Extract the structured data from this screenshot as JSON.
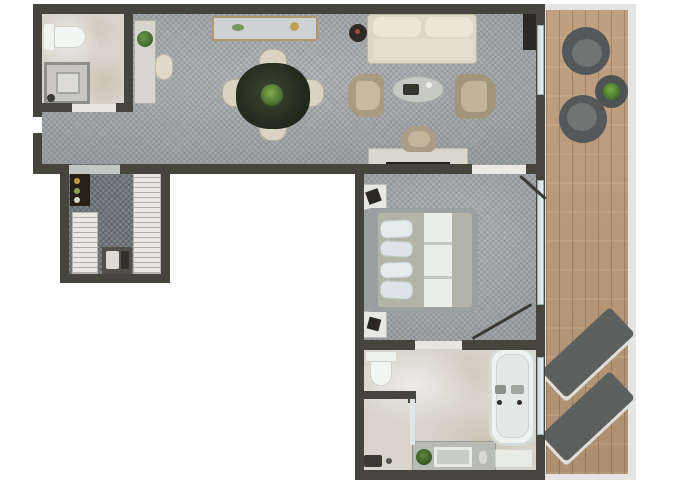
{
  "title": "hotel-suite-floor-plan",
  "canvas": {
    "w": 680,
    "h": 486
  },
  "palette": {
    "wall": "#45443d",
    "carpet": "#a6a9ab",
    "carpet_dark": "#7b8084",
    "marble": "#d8d4ca",
    "wood": "#b79878",
    "railing": "#e4e5e2",
    "cream_fabric": "#dcd8c8",
    "tan_fabric": "#a99b80",
    "dining_table_green": "#27301f",
    "outdoor_gray": "#54585a",
    "fixture_white": "#f2f5f2",
    "plant_green": "#4c7a35",
    "glass": "#dce6e7"
  },
  "floors": [
    {
      "name": "living-room-floor",
      "cls": "floor-carpet",
      "x": 42,
      "y": 12,
      "w": 494,
      "h": 152
    },
    {
      "name": "entry-bathroom-floor",
      "cls": "floor-marble",
      "x": 40,
      "y": 12,
      "w": 92,
      "h": 94
    },
    {
      "name": "closet-floor",
      "cls": "floor-carpet-dark",
      "x": 64,
      "y": 164,
      "w": 104,
      "h": 115
    },
    {
      "name": "bedroom-floor",
      "cls": "floor-carpet",
      "x": 360,
      "y": 164,
      "w": 178,
      "h": 182
    },
    {
      "name": "main-bathroom-floor",
      "cls": "floor-marble",
      "x": 360,
      "y": 346,
      "w": 178,
      "h": 128
    },
    {
      "name": "balcony-railing",
      "x": 544,
      "y": 4,
      "w": 92,
      "h": 476,
      "bg": "#e4e5e2"
    },
    {
      "name": "balcony-floor",
      "cls": "floor-wood",
      "x": 546,
      "y": 10,
      "w": 82,
      "h": 464
    }
  ],
  "furniture": [
    {
      "name": "toilet-tank-entry",
      "x": 44,
      "y": 24,
      "w": 10,
      "h": 26,
      "bg": "#f1f3f0",
      "r": "2px"
    },
    {
      "name": "toilet-bowl-entry",
      "x": 54,
      "y": 26,
      "w": 32,
      "h": 22,
      "bg": "#f3f5f2",
      "r": "2px 12px 12px 2px",
      "b": "1px solid #cfd1cc"
    },
    {
      "name": "shower-entry",
      "x": 44,
      "y": 62,
      "w": 46,
      "h": 42,
      "bg": "#c9c8c0",
      "b": "3px solid #8e8f88"
    },
    {
      "name": "shower-entry-tray",
      "x": 56,
      "y": 72,
      "w": 24,
      "h": 22,
      "bg": "#dddcd4",
      "b": "2px solid #a7a8a0"
    },
    {
      "name": "shower-entry-drain",
      "x": 47,
      "y": 94,
      "w": 8,
      "h": 8,
      "bg": "#3c3a34",
      "r": "50%"
    },
    {
      "name": "hall-cabinet",
      "x": 134,
      "y": 20,
      "w": 22,
      "h": 84,
      "bg": "#d6d6ce",
      "b": "1px solid #b2b2aa"
    },
    {
      "name": "hall-cabinet-plant",
      "x": 137,
      "y": 31,
      "w": 16,
      "h": 16,
      "bg": "radial-gradient(circle at 40% 40%, #6a9448, #2f5122)",
      "r": "50%"
    },
    {
      "name": "hall-chair",
      "x": 155,
      "y": 54,
      "w": 18,
      "h": 26,
      "bg": "#e0dbc9",
      "r": "9px",
      "b": "1px solid #bdb8a6"
    },
    {
      "name": "credenza",
      "x": 212,
      "y": 16,
      "w": 106,
      "h": 25,
      "bg": "#ccd3d2",
      "b": "2px solid #b0976d",
      "r": "3px"
    },
    {
      "name": "credenza-decor-green",
      "x": 232,
      "y": 24,
      "w": 12,
      "h": 7,
      "bg": "#79985f",
      "r": "50%"
    },
    {
      "name": "credenza-decor-gold",
      "x": 290,
      "y": 22,
      "w": 9,
      "h": 9,
      "bg": "#bfa258",
      "r": "50%"
    },
    {
      "name": "dining-chair-north",
      "x": 259,
      "y": 49,
      "w": 28,
      "h": 24,
      "bg": "#d9d4c2",
      "r": "12px 12px 6px 6px",
      "b": "1px solid #b6b09c"
    },
    {
      "name": "dining-chair-south",
      "x": 259,
      "y": 117,
      "w": 28,
      "h": 24,
      "bg": "#d9d4c2",
      "r": "6px 6px 12px 12px",
      "b": "1px solid #b6b09c"
    },
    {
      "name": "dining-chair-west",
      "x": 222,
      "y": 79,
      "w": 24,
      "h": 28,
      "bg": "#d9d4c2",
      "r": "12px 6px 6px 12px",
      "b": "1px solid #b6b09c"
    },
    {
      "name": "dining-chair-east",
      "x": 300,
      "y": 79,
      "w": 24,
      "h": 28,
      "bg": "#d9d4c2",
      "r": "6px 12px 12px 6px",
      "b": "1px solid #b6b09c"
    },
    {
      "name": "dining-table",
      "x": 236,
      "y": 63,
      "w": 74,
      "h": 66,
      "bg": "radial-gradient(circle at 45% 45%, #3a4730, #141b12)",
      "r": "46%"
    },
    {
      "name": "dining-table-plant",
      "x": 261,
      "y": 84,
      "w": 22,
      "h": 22,
      "bg": "radial-gradient(circle at 45% 40%, #7fae4e, #2c4a1d)",
      "r": "50%"
    },
    {
      "name": "sofa",
      "x": 367,
      "y": 14,
      "w": 110,
      "h": 50,
      "bg": "#dcd8c8",
      "r": "4px",
      "b": "1px solid #bbb6a4"
    },
    {
      "name": "sofa-cushion-left",
      "x": 373,
      "y": 17,
      "w": 48,
      "h": 20,
      "bg": "#eae6d8",
      "r": "8px"
    },
    {
      "name": "sofa-cushion-right",
      "x": 425,
      "y": 17,
      "w": 48,
      "h": 20,
      "bg": "#eae6d8",
      "r": "8px"
    },
    {
      "name": "sofa-seat",
      "x": 373,
      "y": 39,
      "w": 100,
      "h": 21,
      "bg": "#e3dfcf",
      "r": "3px"
    },
    {
      "name": "side-table",
      "x": 349,
      "y": 24,
      "w": 18,
      "h": 18,
      "bg": "#2e2a25",
      "r": "50%"
    },
    {
      "name": "side-table-decor",
      "x": 355,
      "y": 29,
      "w": 5,
      "h": 5,
      "bg": "#a04a3a",
      "r": "50%"
    },
    {
      "name": "coffee-table",
      "x": 392,
      "y": 76,
      "w": 52,
      "h": 27,
      "bg": "#c7cac4",
      "r": "50%",
      "b": "1px solid #a9aca6"
    },
    {
      "name": "coffee-table-tray",
      "x": 403,
      "y": 84,
      "w": 16,
      "h": 11,
      "bg": "#35372f",
      "r": "2px"
    },
    {
      "name": "coffee-table-cup",
      "x": 424,
      "y": 80,
      "w": 10,
      "h": 10,
      "bg": "#f2f2ec",
      "r": "50%",
      "b": "2px solid #c9c9c1"
    },
    {
      "name": "armchair-left",
      "x": 348,
      "y": 74,
      "w": 36,
      "h": 43,
      "bg": "#a99b80",
      "r": "16px 8px 8px 16px"
    },
    {
      "name": "armchair-left-seat",
      "x": 356,
      "y": 81,
      "w": 24,
      "h": 29,
      "bg": "#c6ba9f",
      "r": "4px 10px 10px 4px"
    },
    {
      "name": "armchair-right",
      "x": 455,
      "y": 74,
      "w": 41,
      "h": 45,
      "bg": "#a3957a",
      "r": "8px 18px 18px 8px"
    },
    {
      "name": "armchair-right-seat",
      "x": 461,
      "y": 81,
      "w": 26,
      "h": 31,
      "bg": "#c0b499",
      "r": "10px 4px 4px 10px"
    },
    {
      "name": "tv-console",
      "x": 523,
      "y": 13,
      "w": 13,
      "h": 37,
      "bg": "#2b2925"
    },
    {
      "name": "desk",
      "x": 368,
      "y": 148,
      "w": 100,
      "h": 22,
      "bg": "#d9d7ce",
      "b": "1px solid #b9b7ae"
    },
    {
      "name": "desk-tv",
      "x": 386,
      "y": 162,
      "w": 64,
      "h": 9,
      "bg": "#232220"
    },
    {
      "name": "desk-chair",
      "x": 402,
      "y": 126,
      "w": 34,
      "h": 26,
      "bg": "#ab9d85",
      "r": "13px 13px 7px 7px"
    },
    {
      "name": "desk-chair-seat",
      "x": 408,
      "y": 131,
      "w": 22,
      "h": 16,
      "bg": "#c2b69b",
      "r": "8px"
    },
    {
      "name": "minibar",
      "x": 70,
      "y": 173,
      "w": 20,
      "h": 33,
      "bg": "#262019"
    },
    {
      "name": "minibar-bottle-1",
      "x": 74,
      "y": 178,
      "w": 6,
      "h": 6,
      "bg": "#c3973f",
      "r": "50%"
    },
    {
      "name": "minibar-bottle-2",
      "x": 74,
      "y": 188,
      "w": 6,
      "h": 6,
      "bg": "#8fa050",
      "r": "50%"
    },
    {
      "name": "minibar-bottle-3",
      "x": 74,
      "y": 197,
      "w": 6,
      "h": 6,
      "bg": "#d8d8d0",
      "r": "50%"
    },
    {
      "name": "wardrobe-left",
      "cls": "rail",
      "x": 72,
      "y": 212,
      "w": 26,
      "h": 62,
      "b": "1px solid #b4b3ab"
    },
    {
      "name": "wardrobe-right",
      "cls": "rail",
      "x": 133,
      "y": 173,
      "w": 28,
      "h": 101,
      "b": "1px solid #b4b3ab"
    },
    {
      "name": "luggage-bench",
      "x": 102,
      "y": 247,
      "w": 30,
      "h": 27,
      "bg": "#524f47"
    },
    {
      "name": "luggage-item-light",
      "x": 106,
      "y": 251,
      "w": 13,
      "h": 18,
      "bg": "#dbdbd3",
      "r": "2px"
    },
    {
      "name": "luggage-item-dark",
      "x": 121,
      "y": 251,
      "w": 8,
      "h": 18,
      "bg": "#33302a",
      "r": "2px"
    },
    {
      "name": "nightstand-north",
      "x": 363,
      "y": 184,
      "w": 24,
      "h": 26,
      "bg": "#e8e8e2",
      "b": "1px solid #bcbcb4"
    },
    {
      "name": "nightstand-north-decor",
      "x": 367,
      "y": 190,
      "w": 13,
      "h": 13,
      "bg": "#2b2823",
      "rot": -20
    },
    {
      "name": "nightstand-south",
      "x": 363,
      "y": 311,
      "w": 24,
      "h": 27,
      "bg": "#e8e8e2",
      "b": "1px solid #bcbcb4"
    },
    {
      "name": "nightstand-south-decor",
      "x": 368,
      "y": 318,
      "w": 12,
      "h": 12,
      "bg": "#2b2823",
      "rot": 15
    },
    {
      "name": "bed-frame",
      "x": 362,
      "y": 208,
      "w": 116,
      "h": 104,
      "bg": "#9aa09f",
      "r": "10px 6px 6px 10px"
    },
    {
      "name": "bed-mattress",
      "x": 378,
      "y": 213,
      "w": 94,
      "h": 94,
      "bg": "#b2b4a8",
      "r": "3px"
    },
    {
      "name": "bed-runner",
      "x": 424,
      "y": 213,
      "w": 28,
      "h": 94,
      "bg": "#ecefe9"
    },
    {
      "name": "bed-runner-fold-1",
      "x": 424,
      "y": 242,
      "w": 28,
      "h": 3,
      "bg": "#c6c9bf"
    },
    {
      "name": "bed-runner-fold-2",
      "x": 424,
      "y": 276,
      "w": 28,
      "h": 3,
      "bg": "#c6c9bf"
    },
    {
      "name": "pillow-1",
      "x": 380,
      "y": 220,
      "w": 33,
      "h": 18,
      "bg": "#e6ebed",
      "r": "7px",
      "rot": -3,
      "b": "1px solid #c3cbce"
    },
    {
      "name": "pillow-2",
      "x": 380,
      "y": 241,
      "w": 33,
      "h": 16,
      "bg": "#dde4e7",
      "r": "7px",
      "rot": 2,
      "b": "1px solid #c3cbce"
    },
    {
      "name": "pillow-3",
      "x": 380,
      "y": 262,
      "w": 33,
      "h": 16,
      "bg": "#e6ebed",
      "r": "7px",
      "rot": -2,
      "b": "1px solid #c3cbce"
    },
    {
      "name": "pillow-4",
      "x": 380,
      "y": 281,
      "w": 33,
      "h": 18,
      "bg": "#dde4e7",
      "r": "7px",
      "rot": 3,
      "b": "1px solid #c3cbce"
    },
    {
      "name": "toilet-tank-main",
      "x": 366,
      "y": 352,
      "w": 30,
      "h": 9,
      "bg": "#eff1ee",
      "r": "2px"
    },
    {
      "name": "toilet-bowl-main",
      "x": 370,
      "y": 361,
      "w": 22,
      "h": 25,
      "bg": "#f3f5f2",
      "r": "3px 3px 11px 11px",
      "b": "1px solid #cfd1cc"
    },
    {
      "name": "shower-main-fixture",
      "x": 364,
      "y": 455,
      "w": 18,
      "h": 12,
      "bg": "#3b3933",
      "r": "2px"
    },
    {
      "name": "shower-main-drain",
      "x": 386,
      "y": 458,
      "w": 6,
      "h": 6,
      "bg": "#55534b",
      "r": "50%"
    },
    {
      "name": "vanity-counter",
      "x": 412,
      "y": 441,
      "w": 84,
      "h": 31,
      "bg": "#b7bbb3",
      "b": "1px solid #989c94"
    },
    {
      "name": "vanity-sink",
      "x": 434,
      "y": 447,
      "w": 38,
      "h": 20,
      "bg": "#c9cdc5",
      "b": "3px solid #e9ebe5"
    },
    {
      "name": "vanity-plant",
      "x": 416,
      "y": 449,
      "w": 16,
      "h": 16,
      "bg": "radial-gradient(circle at 45% 40%, #5d8a3c, #24401a)",
      "r": "50%"
    },
    {
      "name": "vanity-soap",
      "x": 479,
      "y": 451,
      "w": 8,
      "h": 13,
      "bg": "#d7d9d1",
      "r": "40%"
    },
    {
      "name": "bathtub",
      "x": 489,
      "y": 347,
      "w": 47,
      "h": 99,
      "bg": "#eef3f1",
      "r": "16px",
      "b": "3px solid #d5dbd7"
    },
    {
      "name": "bathtub-basin",
      "x": 496,
      "y": 354,
      "w": 33,
      "h": 84,
      "bg": "#e2e9e7",
      "r": "12px",
      "b": "1px solid #cdd4d1"
    },
    {
      "name": "bathtub-faucet-1",
      "x": 495,
      "y": 385,
      "w": 11,
      "h": 9,
      "bg": "#8e928c",
      "r": "2px"
    },
    {
      "name": "bathtub-faucet-2",
      "x": 511,
      "y": 385,
      "w": 13,
      "h": 9,
      "bg": "#a2a6a0",
      "r": "2px"
    },
    {
      "name": "bathtub-jet-1",
      "x": 497,
      "y": 400,
      "w": 5,
      "h": 5,
      "bg": "#2e2c28",
      "r": "50%"
    },
    {
      "name": "bathtub-jet-2",
      "x": 517,
      "y": 400,
      "w": 5,
      "h": 5,
      "bg": "#2e2c28",
      "r": "50%"
    },
    {
      "name": "bath-mat",
      "x": 495,
      "y": 449,
      "w": 38,
      "h": 19,
      "bg": "#e9ebe5",
      "r": "2px",
      "b": "1px solid #d2d4cc"
    },
    {
      "name": "balcony-chair-1",
      "x": 562,
      "y": 27,
      "w": 48,
      "h": 48,
      "bg": "#54585a",
      "r": "50%"
    },
    {
      "name": "balcony-chair-1-seat",
      "x": 572,
      "y": 39,
      "w": 30,
      "h": 28,
      "bg": "#707574",
      "r": "50%"
    },
    {
      "name": "balcony-chair-2",
      "x": 559,
      "y": 95,
      "w": 48,
      "h": 48,
      "bg": "#54585a",
      "r": "50%"
    },
    {
      "name": "balcony-chair-2-seat",
      "x": 567,
      "y": 103,
      "w": 30,
      "h": 28,
      "bg": "#707574",
      "r": "50%"
    },
    {
      "name": "balcony-table",
      "x": 595,
      "y": 75,
      "w": 33,
      "h": 33,
      "bg": "#4f5354",
      "r": "50%"
    },
    {
      "name": "balcony-table-plant",
      "x": 603,
      "y": 83,
      "w": 17,
      "h": 17,
      "bg": "radial-gradient(circle at 45% 40%, #77ad45, #2d511c)",
      "r": "50%"
    },
    {
      "name": "sun-lounger-1",
      "x": 541,
      "y": 334,
      "w": 94,
      "h": 37,
      "bg": "#5b5f5e",
      "r": "4px",
      "rot": -43,
      "sh": "-3px 3px 0 rgba(230,231,228,0.9)"
    },
    {
      "name": "sun-lounger-2",
      "x": 541,
      "y": 398,
      "w": 94,
      "h": 37,
      "bg": "#5b5f5e",
      "r": "4px",
      "rot": -43,
      "sh": "-3px 3px 0 rgba(230,231,228,0.9)"
    }
  ],
  "walls": [
    {
      "name": "wall-top",
      "x": 33,
      "y": 4,
      "w": 512,
      "h": 10
    },
    {
      "name": "wall-left-upper",
      "x": 33,
      "y": 4,
      "w": 9,
      "h": 113
    },
    {
      "name": "wall-left-lower",
      "x": 33,
      "y": 133,
      "w": 9,
      "h": 41
    },
    {
      "name": "wall-entry-bath-right",
      "x": 124,
      "y": 4,
      "w": 9,
      "h": 102
    },
    {
      "name": "wall-entry-bath-bottom-left",
      "x": 33,
      "y": 103,
      "w": 39,
      "h": 9
    },
    {
      "name": "wall-entry-bath-bottom-right",
      "x": 116,
      "y": 103,
      "w": 17,
      "h": 9
    },
    {
      "name": "wall-band-bottom-left",
      "x": 33,
      "y": 164,
      "w": 39,
      "h": 10
    },
    {
      "name": "wall-band-bottom-mid",
      "x": 120,
      "y": 164,
      "w": 352,
      "h": 10
    },
    {
      "name": "wall-band-bottom-right",
      "x": 526,
      "y": 164,
      "w": 19,
      "h": 10
    },
    {
      "name": "wall-closet-left",
      "x": 60,
      "y": 164,
      "w": 9,
      "h": 118
    },
    {
      "name": "wall-closet-right",
      "x": 161,
      "y": 164,
      "w": 9,
      "h": 118
    },
    {
      "name": "wall-closet-bottom",
      "x": 60,
      "y": 274,
      "w": 110,
      "h": 9
    },
    {
      "name": "wall-wing-left",
      "x": 355,
      "y": 164,
      "w": 9,
      "h": 316
    },
    {
      "name": "wall-bedroom-bottom-left",
      "x": 355,
      "y": 340,
      "w": 60,
      "h": 10
    },
    {
      "name": "wall-bedroom-bottom-right",
      "x": 462,
      "y": 340,
      "w": 83,
      "h": 10
    },
    {
      "name": "wall-bathroom-bottom",
      "x": 355,
      "y": 470,
      "w": 190,
      "h": 10
    },
    {
      "name": "wall-east",
      "x": 536,
      "y": 4,
      "w": 9,
      "h": 476
    },
    {
      "name": "wall-shower-top",
      "x": 362,
      "y": 391,
      "w": 52,
      "h": 8
    },
    {
      "name": "wall-shower-stub",
      "x": 408,
      "y": 391,
      "w": 8,
      "h": 12
    }
  ],
  "thresholds": [
    {
      "name": "threshold-entry-bath",
      "x": 72,
      "y": 104,
      "w": 44,
      "h": 8,
      "bg": "#e7e5de"
    },
    {
      "name": "threshold-closet",
      "x": 69,
      "y": 165,
      "w": 51,
      "h": 9,
      "bg": "#c4c6c3"
    },
    {
      "name": "threshold-bedroom",
      "x": 472,
      "y": 165,
      "w": 54,
      "h": 9,
      "bg": "#e9e8e3"
    },
    {
      "name": "threshold-main-bath",
      "x": 415,
      "y": 341,
      "w": 47,
      "h": 8,
      "bg": "#e7e5de"
    },
    {
      "name": "threshold-shower-glass",
      "x": 410,
      "y": 399,
      "w": 5,
      "h": 46,
      "bg": "#dfe7e8"
    }
  ],
  "glass": [
    {
      "name": "window-living",
      "x": 537,
      "y": 25,
      "w": 7,
      "h": 70
    },
    {
      "name": "window-bedroom",
      "x": 537,
      "y": 180,
      "w": 7,
      "h": 125
    },
    {
      "name": "window-bathroom",
      "x": 537,
      "y": 357,
      "w": 7,
      "h": 78
    }
  ],
  "doors": [
    {
      "name": "door-swing-bedroom",
      "x": 516,
      "y": 186,
      "w": 34,
      "h": 3,
      "rot": 42
    },
    {
      "name": "door-swing-bathroom",
      "x": 468,
      "y": 320,
      "w": 68,
      "h": 3,
      "rot": -30
    }
  ]
}
